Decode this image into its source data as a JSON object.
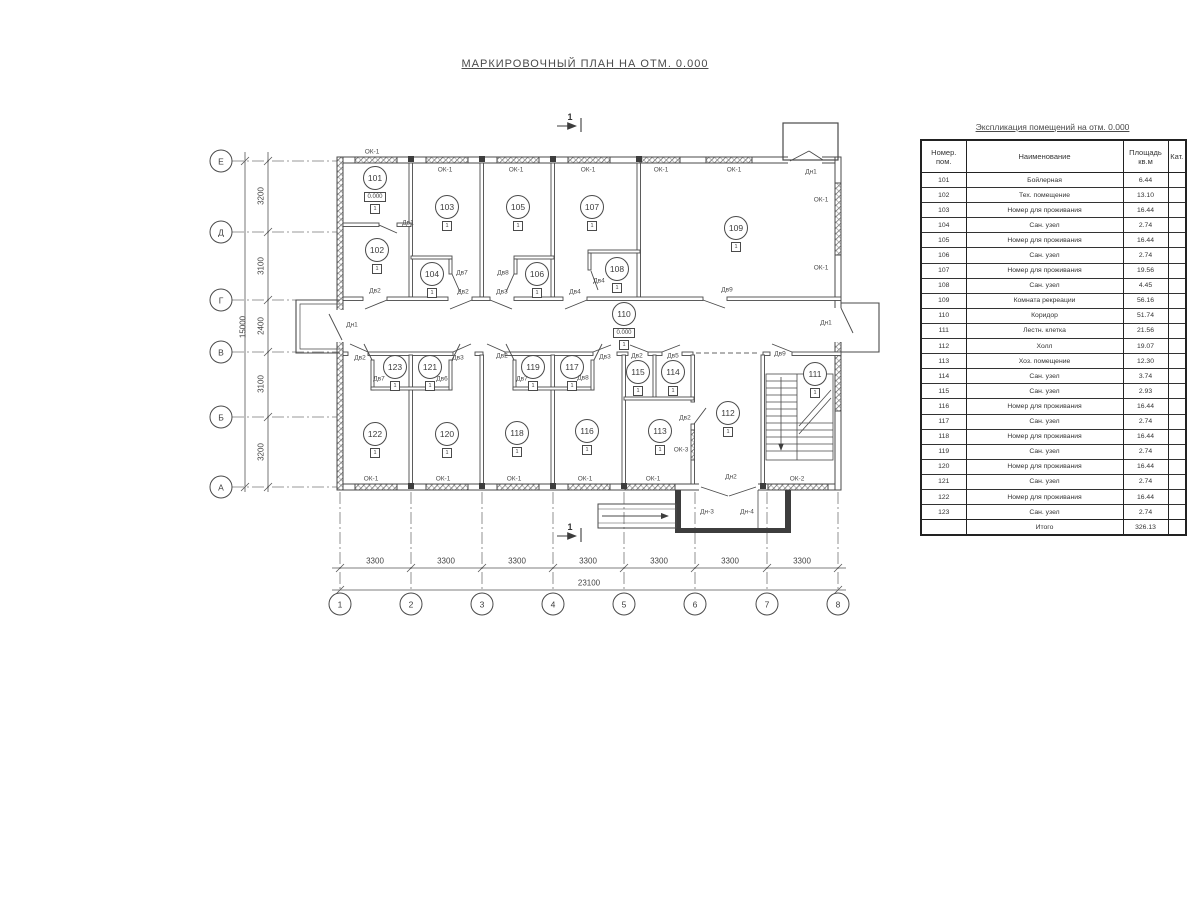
{
  "title": "МАРКИРОВОЧНЫЙ ПЛАН НА ОТМ. 0.000",
  "table": {
    "title": "Экспликация помещений на отм. 0.000",
    "headers": {
      "num": "Номер.\nпом.",
      "name": "Наименование",
      "area": "Площадь\nкв.м",
      "cat": "Кат."
    },
    "rows": [
      [
        "101",
        "Бойлерная",
        "6.44"
      ],
      [
        "102",
        "Тех. помещение",
        "13.10"
      ],
      [
        "103",
        "Номер для проживания",
        "16.44"
      ],
      [
        "104",
        "Сан. узел",
        "2.74"
      ],
      [
        "105",
        "Номер для проживания",
        "16.44"
      ],
      [
        "106",
        "Сан. узел",
        "2.74"
      ],
      [
        "107",
        "Номер для проживания",
        "19.56"
      ],
      [
        "108",
        "Сан. узел",
        "4.45"
      ],
      [
        "109",
        "Комната рекреации",
        "56.16"
      ],
      [
        "110",
        "Коридор",
        "51.74"
      ],
      [
        "111",
        "Лестн. клетка",
        "21.56"
      ],
      [
        "112",
        "Холл",
        "19.07"
      ],
      [
        "113",
        "Хоз. помещение",
        "12.30"
      ],
      [
        "114",
        "Сан. узел",
        "3.74"
      ],
      [
        "115",
        "Сан. узел",
        "2.93"
      ],
      [
        "116",
        "Номер для проживания",
        "16.44"
      ],
      [
        "117",
        "Сан. узел",
        "2.74"
      ],
      [
        "118",
        "Номер для проживания",
        "16.44"
      ],
      [
        "119",
        "Сан. узел",
        "2.74"
      ],
      [
        "120",
        "Номер для проживания",
        "16.44"
      ],
      [
        "121",
        "Сан. узел",
        "2.74"
      ],
      [
        "122",
        "Номер для проживания",
        "16.44"
      ],
      [
        "123",
        "Сан. узел",
        "2.74"
      ]
    ],
    "total_label": "Итого",
    "total_value": "326.13"
  },
  "plan": {
    "axis_row_x": 221,
    "axis_col_y": 604,
    "axis_rows": [
      {
        "label": "Е",
        "y": 161
      },
      {
        "label": "Д",
        "y": 232
      },
      {
        "label": "Г",
        "y": 300
      },
      {
        "label": "В",
        "y": 352
      },
      {
        "label": "Б",
        "y": 417
      },
      {
        "label": "А",
        "y": 487
      }
    ],
    "axis_cols": [
      {
        "label": "1",
        "x": 340
      },
      {
        "label": "2",
        "x": 411
      },
      {
        "label": "3",
        "x": 482
      },
      {
        "label": "4",
        "x": 553
      },
      {
        "label": "5",
        "x": 624
      },
      {
        "label": "6",
        "x": 695
      },
      {
        "label": "7",
        "x": 767
      },
      {
        "label": "8",
        "x": 838
      }
    ],
    "rooms": [
      {
        "id": "101",
        "x": 375,
        "y": 177,
        "level": "0.000",
        "mark": "1"
      },
      {
        "id": "102",
        "x": 377,
        "y": 249,
        "mark": "1"
      },
      {
        "id": "103",
        "x": 447,
        "y": 206,
        "mark": "1"
      },
      {
        "id": "104",
        "x": 432,
        "y": 273,
        "mark": "1"
      },
      {
        "id": "105",
        "x": 518,
        "y": 206,
        "mark": "1"
      },
      {
        "id": "106",
        "x": 537,
        "y": 273,
        "mark": "1"
      },
      {
        "id": "107",
        "x": 592,
        "y": 206,
        "mark": "1"
      },
      {
        "id": "108",
        "x": 617,
        "y": 268,
        "mark": "1"
      },
      {
        "id": "109",
        "x": 736,
        "y": 227,
        "mark": "1"
      },
      {
        "id": "110",
        "x": 624,
        "y": 313,
        "level": "0.000",
        "mark": "1"
      },
      {
        "id": "111",
        "x": 815,
        "y": 373,
        "mark": "1"
      },
      {
        "id": "112",
        "x": 728,
        "y": 412,
        "mark": "1"
      },
      {
        "id": "113",
        "x": 660,
        "y": 430,
        "mark": "1"
      },
      {
        "id": "114",
        "x": 673,
        "y": 371,
        "mark": "1"
      },
      {
        "id": "115",
        "x": 638,
        "y": 371,
        "mark": "1"
      },
      {
        "id": "116",
        "x": 587,
        "y": 430,
        "mark": "1"
      },
      {
        "id": "117",
        "x": 572,
        "y": 366,
        "mark": "1"
      },
      {
        "id": "118",
        "x": 517,
        "y": 432,
        "mark": "1"
      },
      {
        "id": "119",
        "x": 533,
        "y": 366,
        "mark": "1"
      },
      {
        "id": "120",
        "x": 447,
        "y": 433,
        "mark": "1"
      },
      {
        "id": "121",
        "x": 430,
        "y": 366,
        "mark": "1"
      },
      {
        "id": "122",
        "x": 375,
        "y": 433,
        "mark": "1"
      },
      {
        "id": "123",
        "x": 395,
        "y": 366,
        "mark": "1"
      }
    ],
    "labels": [
      {
        "text": "ОК-1",
        "x": 372,
        "y": 152
      },
      {
        "text": "ОК-1",
        "x": 445,
        "y": 170
      },
      {
        "text": "ОК-1",
        "x": 516,
        "y": 170
      },
      {
        "text": "ОК-1",
        "x": 588,
        "y": 170
      },
      {
        "text": "ОК-1",
        "x": 661,
        "y": 170
      },
      {
        "text": "ОК-1",
        "x": 734,
        "y": 170
      },
      {
        "text": "Дн1",
        "x": 811,
        "y": 172
      },
      {
        "text": "ОК-1",
        "x": 821,
        "y": 200
      },
      {
        "text": "ОК-1",
        "x": 821,
        "y": 268
      },
      {
        "text": "ОК-1",
        "x": 371,
        "y": 479
      },
      {
        "text": "ОК-1",
        "x": 443,
        "y": 479
      },
      {
        "text": "ОК-1",
        "x": 514,
        "y": 479
      },
      {
        "text": "ОК-1",
        "x": 585,
        "y": 479
      },
      {
        "text": "ОК-1",
        "x": 653,
        "y": 479
      },
      {
        "text": "Дн2",
        "x": 731,
        "y": 477
      },
      {
        "text": "ОК-2",
        "x": 797,
        "y": 479
      },
      {
        "text": "ОК-3",
        "x": 681,
        "y": 450
      },
      {
        "text": "Дн-3",
        "x": 707,
        "y": 512
      },
      {
        "text": "Дн-4",
        "x": 747,
        "y": 512
      },
      {
        "text": "Дв1",
        "x": 408,
        "y": 223
      },
      {
        "text": "Дв2",
        "x": 375,
        "y": 291
      },
      {
        "text": "Дв7",
        "x": 462,
        "y": 273
      },
      {
        "text": "Дв2",
        "x": 463,
        "y": 292
      },
      {
        "text": "Дв8",
        "x": 503,
        "y": 273
      },
      {
        "text": "Дв3",
        "x": 502,
        "y": 292
      },
      {
        "text": "Дв4",
        "x": 599,
        "y": 281
      },
      {
        "text": "Дв4",
        "x": 575,
        "y": 292
      },
      {
        "text": "Дв9",
        "x": 727,
        "y": 290
      },
      {
        "text": "Дн1",
        "x": 352,
        "y": 325
      },
      {
        "text": "Дн1",
        "x": 826,
        "y": 323
      },
      {
        "text": "Дв2",
        "x": 360,
        "y": 358
      },
      {
        "text": "Дв7",
        "x": 379,
        "y": 379
      },
      {
        "text": "Дв6",
        "x": 442,
        "y": 379
      },
      {
        "text": "Дв3",
        "x": 458,
        "y": 358
      },
      {
        "text": "Дв2",
        "x": 502,
        "y": 356
      },
      {
        "text": "Дв7",
        "x": 522,
        "y": 379
      },
      {
        "text": "Дв8",
        "x": 583,
        "y": 378
      },
      {
        "text": "Дв3",
        "x": 605,
        "y": 357
      },
      {
        "text": "Дв2",
        "x": 637,
        "y": 356
      },
      {
        "text": "Дв5",
        "x": 673,
        "y": 356
      },
      {
        "text": "Дв9",
        "x": 780,
        "y": 354
      },
      {
        "text": "Дв2",
        "x": 685,
        "y": 418
      },
      {
        "text": "3300",
        "x": 375,
        "y": 561,
        "cls": "dim"
      },
      {
        "text": "3300",
        "x": 446,
        "y": 561,
        "cls": "dim"
      },
      {
        "text": "3300",
        "x": 517,
        "y": 561,
        "cls": "dim"
      },
      {
        "text": "3300",
        "x": 588,
        "y": 561,
        "cls": "dim"
      },
      {
        "text": "3300",
        "x": 659,
        "y": 561,
        "cls": "dim"
      },
      {
        "text": "3300",
        "x": 730,
        "y": 561,
        "cls": "dim"
      },
      {
        "text": "3300",
        "x": 802,
        "y": 561,
        "cls": "dim"
      },
      {
        "text": "23100",
        "x": 589,
        "y": 583,
        "cls": "dim"
      },
      {
        "text": "3200",
        "x": 261,
        "y": 196,
        "cls": "dim",
        "rot": true
      },
      {
        "text": "3100",
        "x": 261,
        "y": 266,
        "cls": "dim",
        "rot": true
      },
      {
        "text": "2400",
        "x": 261,
        "y": 326,
        "cls": "dim",
        "rot": true
      },
      {
        "text": "3100",
        "x": 261,
        "y": 384,
        "cls": "dim",
        "rot": true
      },
      {
        "text": "3200",
        "x": 261,
        "y": 452,
        "cls": "dim",
        "rot": true
      },
      {
        "text": "15000",
        "x": 243,
        "y": 327,
        "cls": "dim",
        "rot": true
      },
      {
        "text": "1",
        "x": 570,
        "y": 117,
        "cls": "sec"
      },
      {
        "text": "1",
        "x": 570,
        "y": 527,
        "cls": "sec"
      }
    ]
  }
}
